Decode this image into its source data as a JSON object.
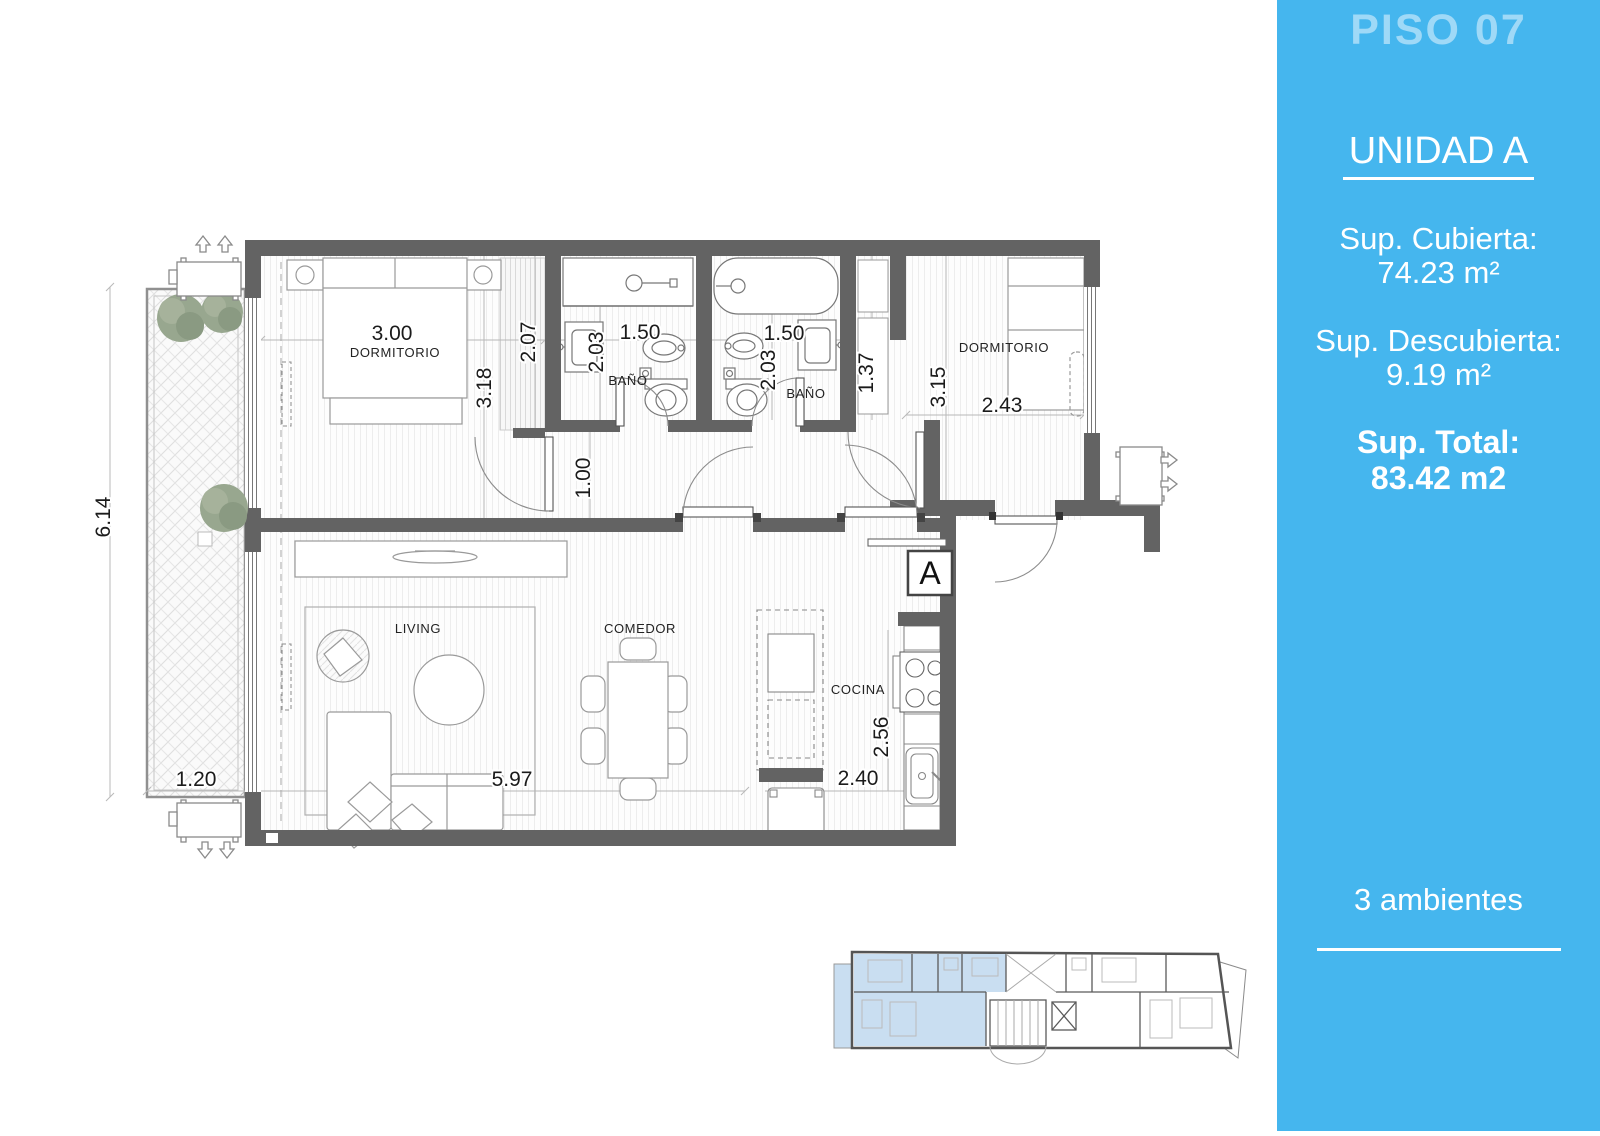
{
  "sidebar": {
    "floor_label": "PISO 07",
    "unit_label": "UNIDAD A",
    "covered_label": "Sup. Cubierta:",
    "covered_value": "74.23 m²",
    "uncovered_label": "Sup. Descubierta:",
    "uncovered_value": "9.19 m²",
    "total_label": "Sup. Total:",
    "total_value": "83.42 m2",
    "rooms_count": "3 ambientes"
  },
  "plan": {
    "marker": "A",
    "rooms": [
      {
        "id": "dormitorio-1",
        "label": "DORMITORIO"
      },
      {
        "id": "bano-1",
        "label": "BAÑO"
      },
      {
        "id": "bano-2",
        "label": "BAÑO"
      },
      {
        "id": "dormitorio-2",
        "label": "DORMITORIO"
      },
      {
        "id": "living",
        "label": "LIVING"
      },
      {
        "id": "comedor",
        "label": "COMEDOR"
      },
      {
        "id": "cocina",
        "label": "COCINA"
      }
    ],
    "dimensions": [
      {
        "id": "dorm1-width",
        "value": "3.00"
      },
      {
        "id": "dorm1-depth",
        "value": "3.18"
      },
      {
        "id": "dorm1-closet-depth",
        "value": "2.07"
      },
      {
        "id": "bano1-width",
        "value": "1.50"
      },
      {
        "id": "bano1-depth",
        "value": "2.03"
      },
      {
        "id": "bano2-width",
        "value": "1.50"
      },
      {
        "id": "bano2-depth",
        "value": "2.03"
      },
      {
        "id": "closet2-width",
        "value": "1.37"
      },
      {
        "id": "dorm2-depth",
        "value": "3.15"
      },
      {
        "id": "dorm2-width",
        "value": "2.43"
      },
      {
        "id": "hall-width",
        "value": "1.00"
      },
      {
        "id": "balcony-length",
        "value": "6.14"
      },
      {
        "id": "balcony-width",
        "value": "1.20"
      },
      {
        "id": "living-width",
        "value": "5.97"
      },
      {
        "id": "kitchen-passage",
        "value": "2.40"
      },
      {
        "id": "kitchen-depth",
        "value": "2.56"
      }
    ]
  },
  "colors": {
    "sidebar_bg": "#45B6EE",
    "sidebar_title": "#9FD9F7",
    "wall": "#636363",
    "tree": "#98A78F",
    "keyplan_highlight": "#C9DEF1"
  }
}
